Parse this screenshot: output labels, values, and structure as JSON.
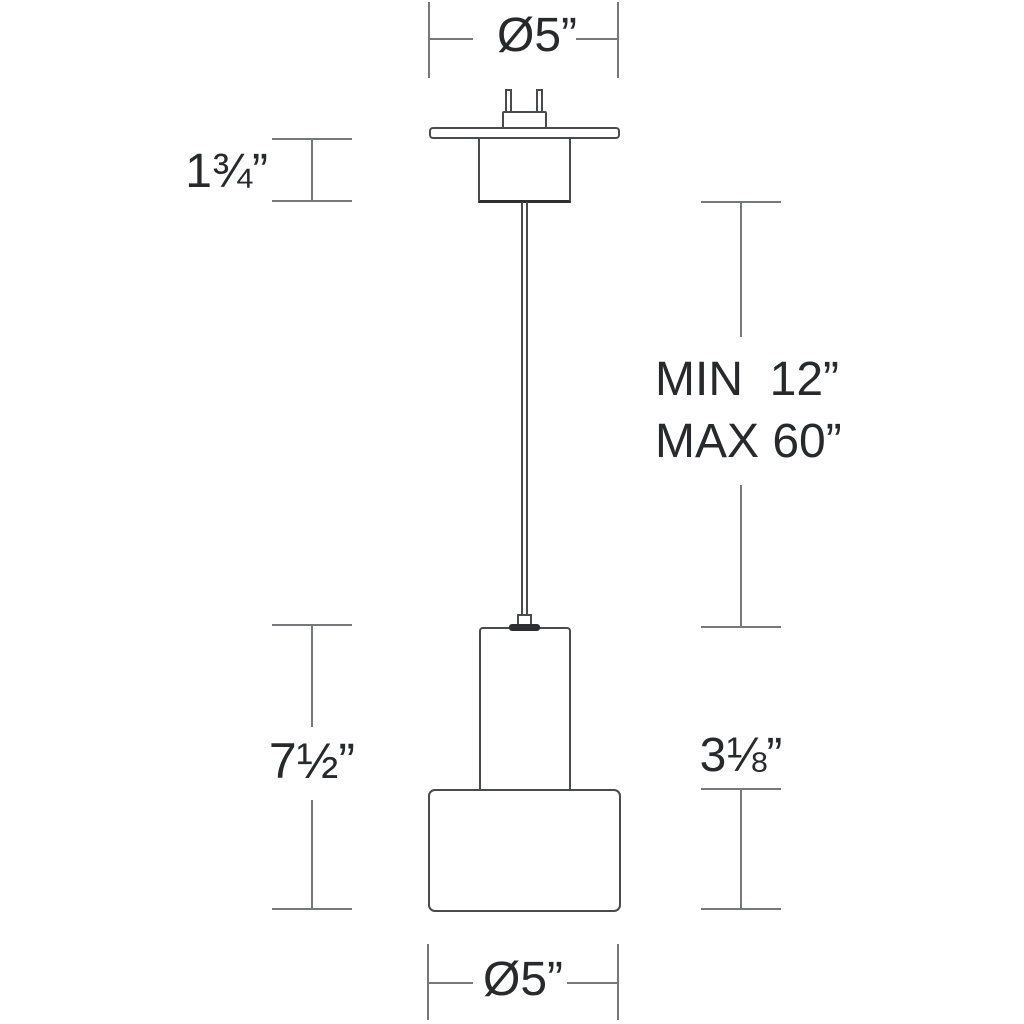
{
  "diagram": {
    "title": "pendant-light-dimension-drawing",
    "labels": {
      "canopy_diameter": "Ø5”",
      "canopy_height": "1¾”",
      "suspension_min": "MIN  12”",
      "suspension_max": "MAX 60”",
      "fixture_height": "7½”",
      "shade_height": "3⅛”",
      "shade_diameter": "Ø5”"
    },
    "colors": {
      "dimension_line": "#77787b",
      "object_outline": "#4a4b4d",
      "dark_accent": "#2d2e30",
      "text": "#28292b",
      "background": "#ffffff"
    }
  }
}
